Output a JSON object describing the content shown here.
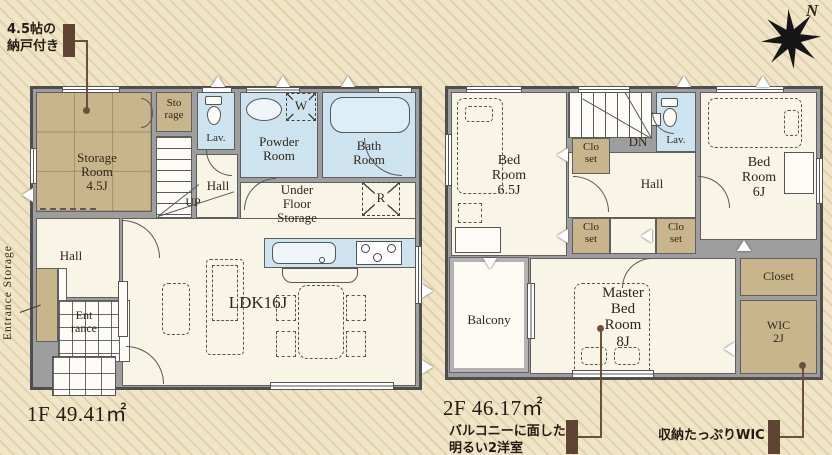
{
  "compass": {
    "n": "N"
  },
  "notes": {
    "storage": "4.5帖の\n納戸付き",
    "balcony_rooms": "バルコニーに面した\n明るい2洋室",
    "wic": "収納たっぷりWIC"
  },
  "floor1": {
    "area": "1F 49.41㎡",
    "storage_room": "Storage\nRoom\n4.5J",
    "storage_closet": "Sto\nrage",
    "lav": "Lav.",
    "powder_room": "Powder\nRoom",
    "bath_room": "Bath\nRoom",
    "hall_upper": "Hall",
    "up": "UP",
    "washer": "W",
    "under_floor": "Under\nFloor\nStorage",
    "fridge": "R",
    "ldk": "LDK16J",
    "hall_lower": "Hall",
    "entrance": "Ent\nrance",
    "entrance_storage": "Entrance Storage"
  },
  "floor2": {
    "area": "2F 46.17㎡",
    "bedroom_65": "Bed\nRoom\n6.5J",
    "dn": "DN",
    "lav": "Lav.",
    "bedroom_6": "Bed\nRoom\n6J",
    "hall": "Hall",
    "closet_a": "Clo\nset",
    "closet_b": "Clo\nset",
    "closet_c": "Clo\nset",
    "closet_right": "Closet",
    "wic": "WIC\n2J",
    "master_bedroom": "Master\nBed\nRoom\n8J",
    "balcony": "Balcony"
  },
  "colors": {
    "background": "#f0e5c6",
    "wall": "#9e9e9e",
    "water_room": "#cde4f0",
    "storage_fill": "#c9b58c",
    "callout": "#5f4434"
  }
}
